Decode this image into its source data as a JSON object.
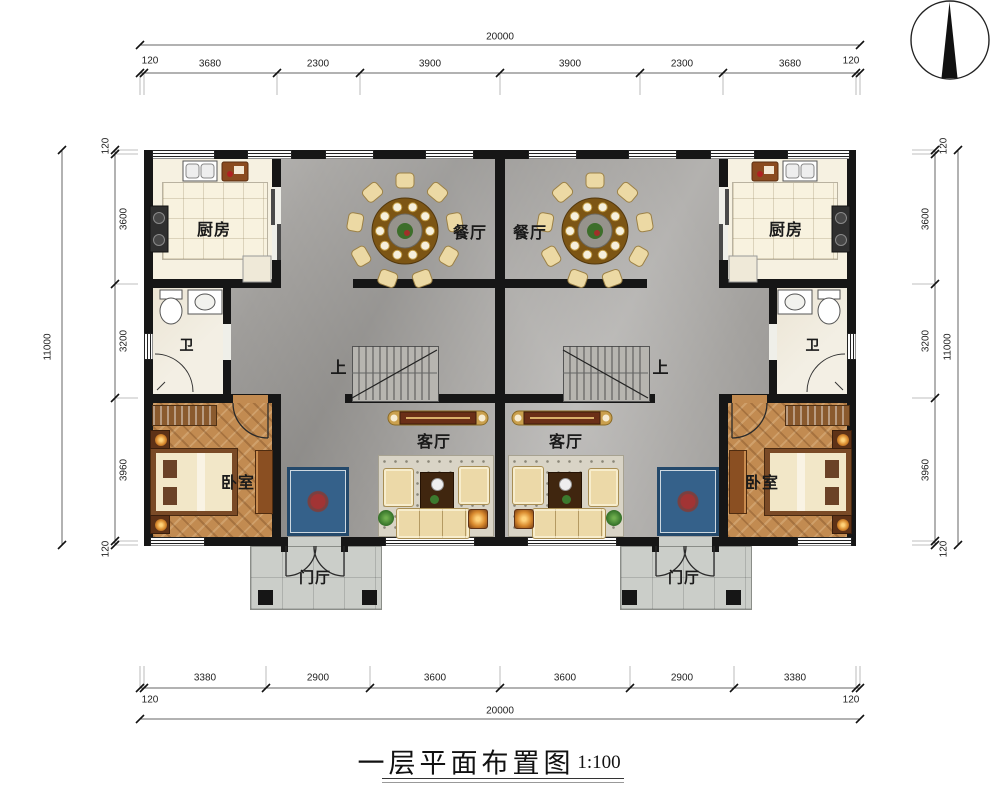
{
  "drawing": {
    "title": "一层平面布置图",
    "scale": "1:100"
  },
  "rooms": {
    "kitchen_left": "厨房",
    "kitchen_right": "厨房",
    "dining_left": "餐厅",
    "dining_right": "餐厅",
    "bath_left": "卫",
    "bath_right": "卫",
    "bedroom_left": "卧室",
    "bedroom_right": "卧室",
    "living_left": "客厅",
    "living_right": "客厅",
    "foyer_left": "门厅",
    "foyer_right": "门厅",
    "stair_up_left": "上",
    "stair_up_right": "上"
  },
  "dims": {
    "top": {
      "total": "20000",
      "end_left": "120",
      "end_right": "120",
      "segments": [
        "3680",
        "2300",
        "3900",
        "3900",
        "2300",
        "3680"
      ]
    },
    "bottom": {
      "total": "20000",
      "end_left": "120",
      "end_right": "120",
      "segments": [
        "3380",
        "2900",
        "3600",
        "3600",
        "2900",
        "3380"
      ]
    },
    "left": {
      "total": "11000",
      "end_top": "120",
      "end_bottom": "120",
      "segments": [
        "3600",
        "3200",
        "3960"
      ]
    },
    "right": {
      "total": "11000",
      "end_top": "120",
      "end_bottom": "120",
      "segments": [
        "3600",
        "3200",
        "3960"
      ]
    }
  },
  "colors": {
    "wall": "#161616",
    "marble": "#a3a19e",
    "wood": "#c28b51",
    "rug": "#35618a"
  }
}
